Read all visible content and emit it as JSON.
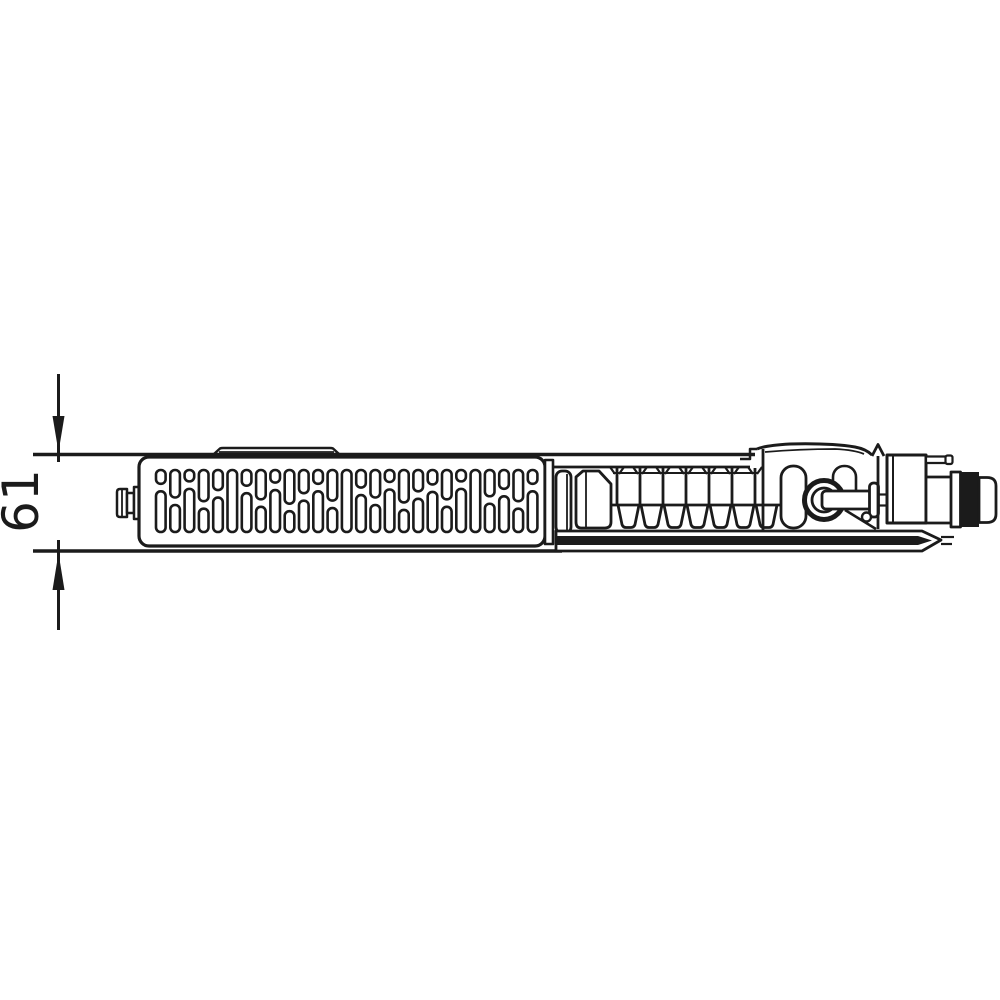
{
  "diagram": {
    "title": "radiator profile technical drawing, top view",
    "dimension": {
      "label": "61"
    },
    "colors": {
      "line": "#1b1b1b",
      "background": "#ffffff"
    }
  }
}
